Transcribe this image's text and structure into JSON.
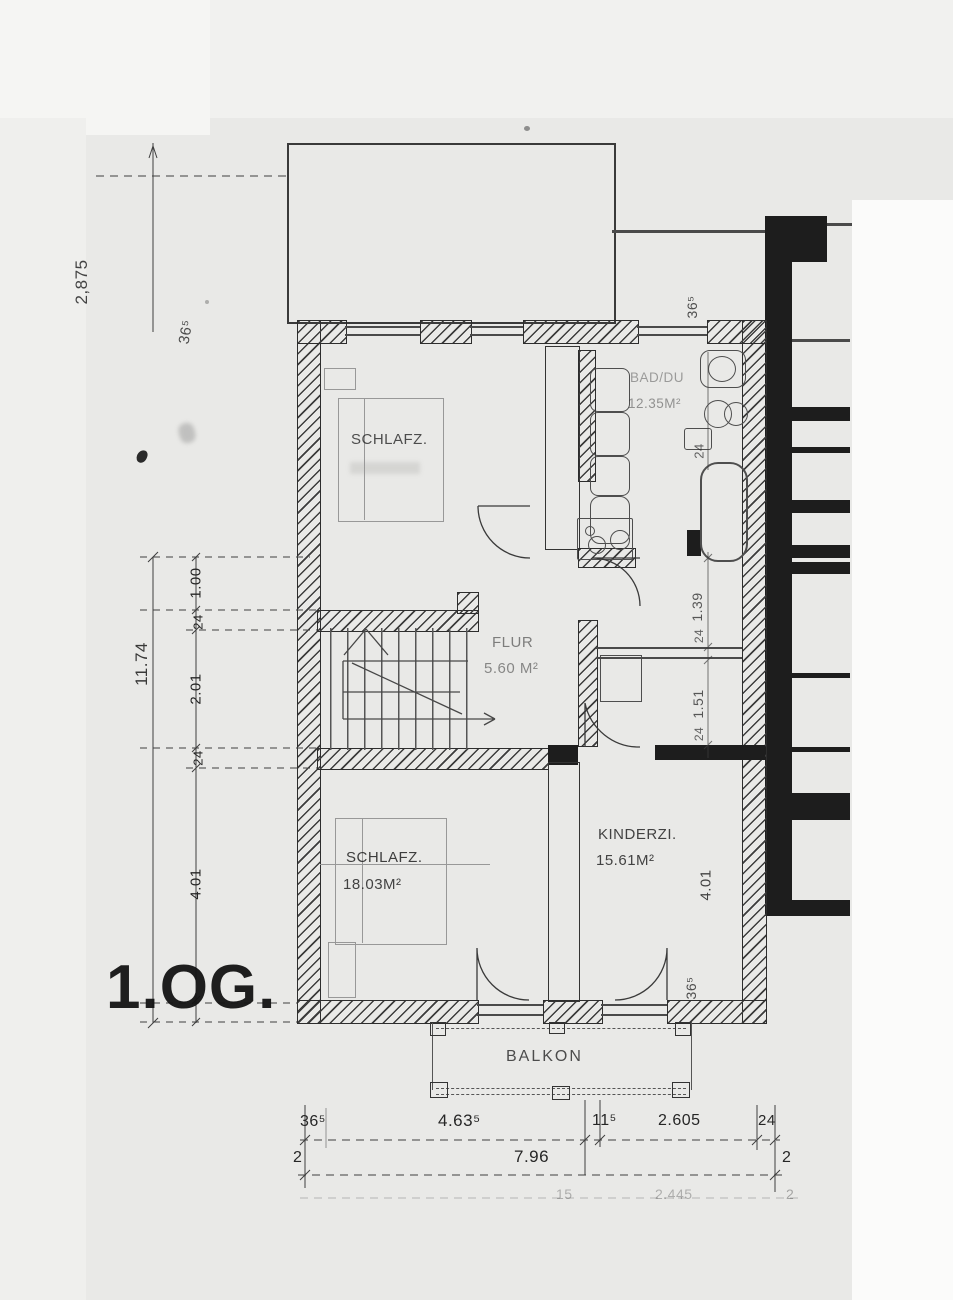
{
  "floor_label": "1.OG.",
  "rooms": {
    "schlafz1": {
      "label": "SCHLAFZ.",
      "area": ""
    },
    "bad": {
      "label": "BAD/DU",
      "area": "12.35M²"
    },
    "flur": {
      "label": "FLUR",
      "area": "5.60 M²"
    },
    "schlafz2": {
      "label": "SCHLAFZ.",
      "area": "18.03M²"
    },
    "kinderzimmer": {
      "label": "KINDERZI.",
      "area": "15.61M²"
    },
    "balkon": {
      "label": "BALKON"
    }
  },
  "dims": {
    "top_left": "2,875",
    "top_left_wall": "36⁵",
    "left_total": "11.74",
    "left_chain": [
      "1.00",
      "24",
      "2.01",
      "24",
      "4.01"
    ],
    "right_top_wall": "36⁵",
    "right_chain": [
      "24",
      "1.39",
      "24",
      "1.51",
      "24"
    ],
    "right_room": "4.01",
    "right_bottom_wall": "36⁵",
    "bottom_row1": [
      "36⁵",
      "4.63⁵",
      "11⁵",
      "2.605",
      "24"
    ],
    "bottom_row2": [
      "2",
      "7.96",
      "2"
    ],
    "bottom_row3_faint": [
      "15",
      "2.445",
      "2"
    ]
  },
  "colors": {
    "paper": "#e9e9e7",
    "ink": "#1d1d1d"
  }
}
